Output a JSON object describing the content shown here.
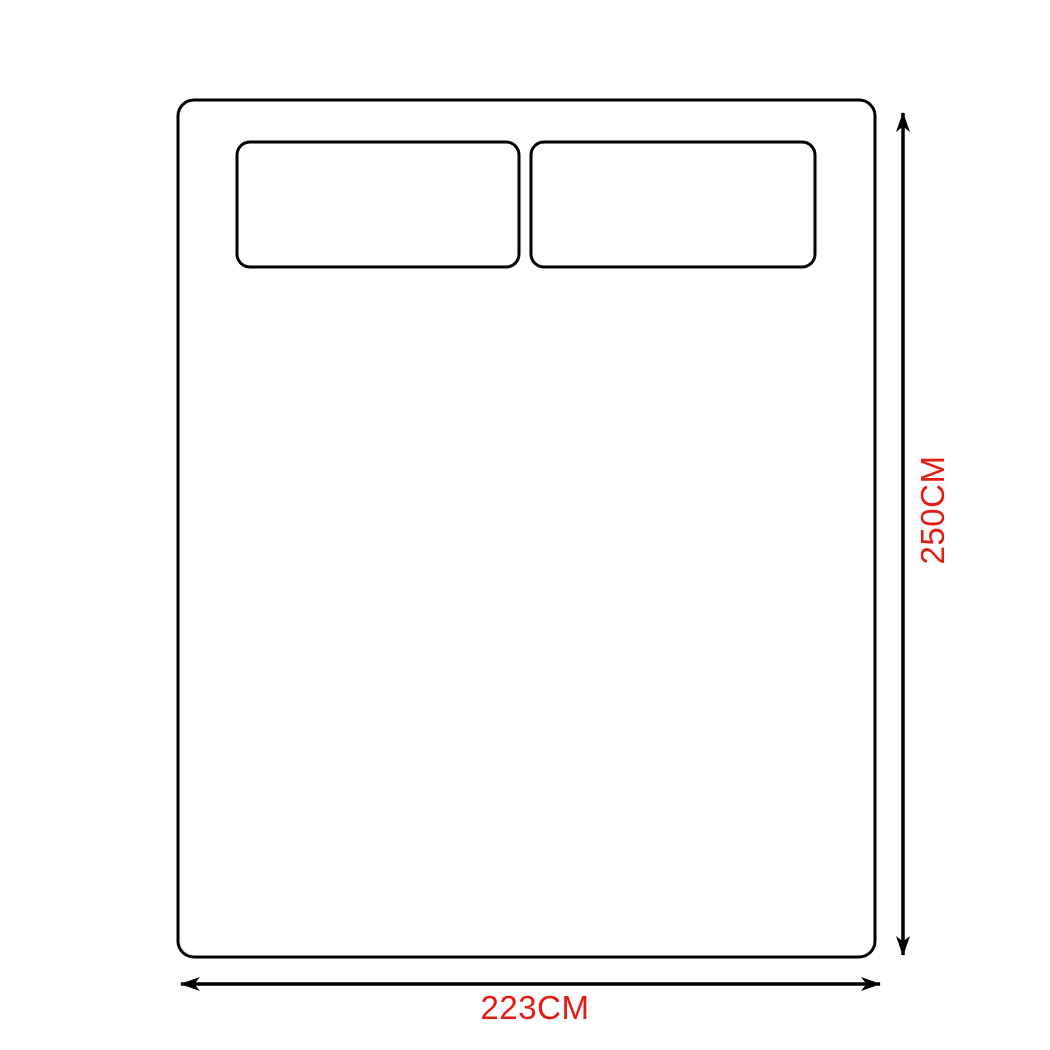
{
  "diagram": {
    "vertical_dimension_label": "250CM",
    "horizontal_dimension_label": "223CM",
    "icons": {
      "vertical_arrow_icon": "double-headed-arrow-vertical",
      "horizontal_arrow_icon": "double-headed-arrow-horizontal"
    },
    "colors": {
      "outline": "#000000",
      "dimension_label": "#e41b13",
      "background": "#ffffff"
    }
  }
}
